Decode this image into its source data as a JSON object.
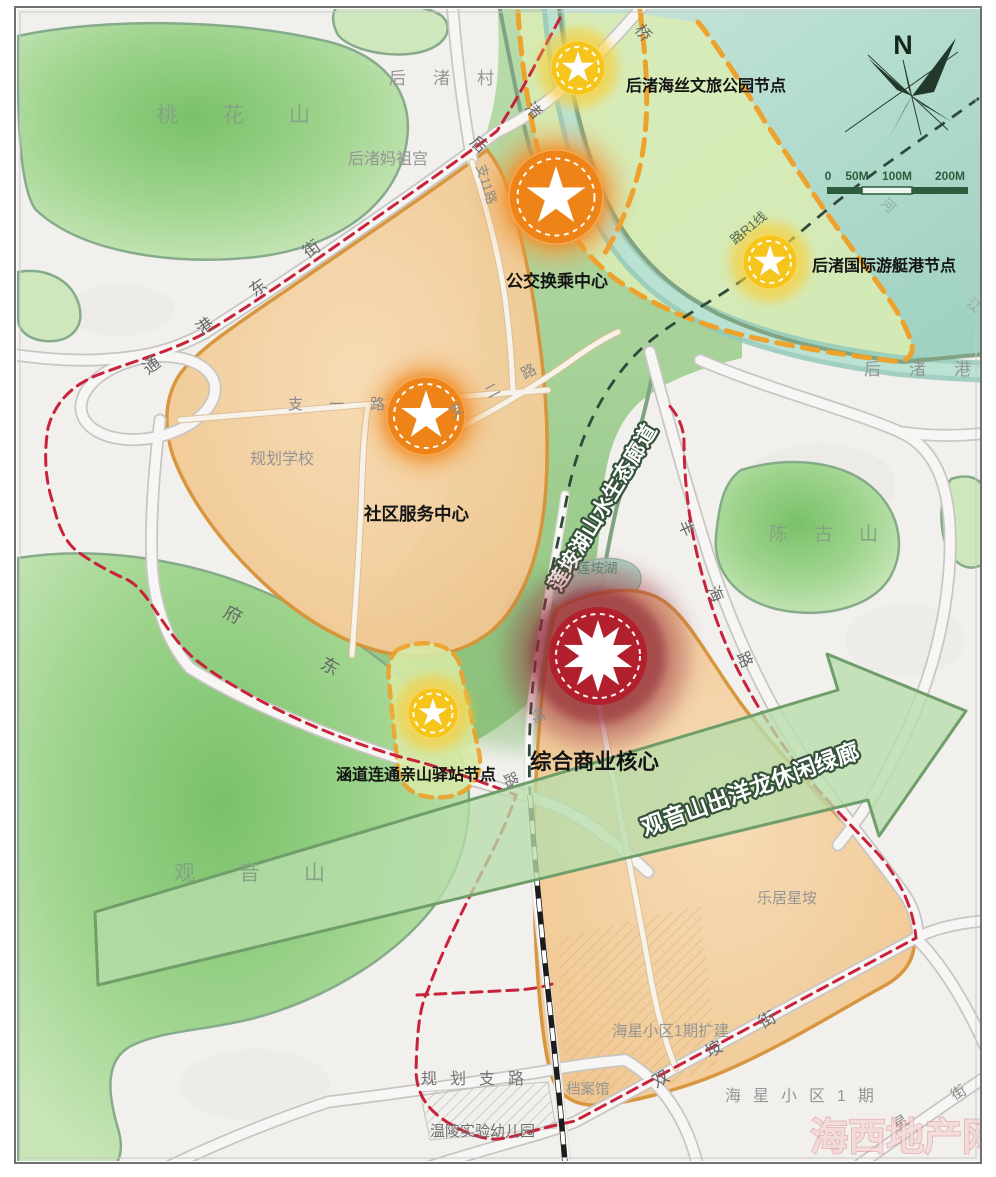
{
  "compass": {
    "north_label": "N"
  },
  "scale_bar": {
    "ticks": [
      "0",
      "50M",
      "100M",
      "200M"
    ]
  },
  "nodes": {
    "park": "后渚海丝文旅公园节点",
    "yacht": "后渚国际游艇港节点",
    "bus": "公交换乘中心",
    "community": "社区服务中心",
    "station": "涵道连通亲山驿站节点",
    "core": "综合商业核心"
  },
  "corridors": {
    "eco": "莲垵湖山水生态廊道",
    "leisure": "观音山出洋龙休闲绿廊"
  },
  "areas": {
    "taohuashan": "桃花山",
    "guanyinshan": "观音山",
    "chengushan": "陈古山",
    "houzhu_village": "后渚村",
    "houzhu_port": "后渚港",
    "mazu_temple": "后渚妈祖宫",
    "planned_school": "规划学校",
    "lianan_lake": "莲垵湖",
    "leju_xingan": "乐居星垵",
    "haixing_expansion": "海星小区1期扩建",
    "haixing_phase1": "海星小区1期",
    "archives": "档案馆",
    "kindergarten": "温陵实验幼儿园"
  },
  "roads": {
    "tonggang_east_street": "通港东街",
    "bridge_char": "桥",
    "zhu_char": "渚",
    "hou_char": "后",
    "zhi11_road": "支11路",
    "zhi1_road": "支一路",
    "zhi2_road": "支二路",
    "fudong_road": "府东",
    "fenghai_road": "丰海路",
    "wei_char": "纬",
    "lu_char": "路",
    "r1_line": "路R1线",
    "shuangan_street": "双垵街",
    "planned_branch_road": "规划支路",
    "xing_char": "星",
    "jie_char": "街",
    "he_char": "河",
    "jiang_char": "江"
  },
  "watermark": {
    "text": "海西地产网"
  },
  "colors": {
    "harbor_teal": "#a9d8c9",
    "corridor_green": "#9dca8e",
    "mountain_green": "#9ed48d",
    "zone_orange": "#f3cd9e",
    "zone_border": "#d8943a",
    "scope_dash_orange": "#eda22d",
    "boundary_red": "#c8233a",
    "rail_line": "#31493a",
    "node_orange": "#ee8418",
    "node_yellow": "#f6c51c",
    "core_red": "#b2202e",
    "arrow_green": "#b7dcaa"
  }
}
